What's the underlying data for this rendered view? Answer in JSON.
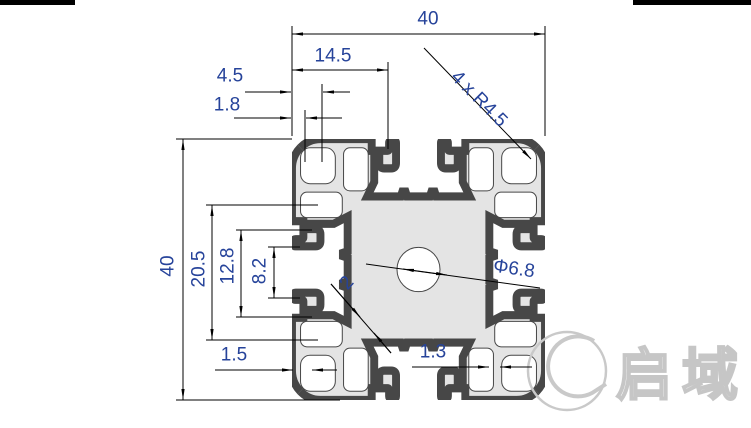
{
  "dimensions": {
    "width_total": "40",
    "height_total": "40",
    "slot_offset": "14.5",
    "corner_radius": "4 x R4.5",
    "lip_depth": "4.5",
    "lip_wall": "1.8",
    "groove_span": "20.5",
    "groove_width": "12.8",
    "slot_opening": "8.2",
    "bottom_wall": "1.5",
    "inner_wall": "1.3",
    "rib_thickness": "2",
    "center_hole_dia": "Φ6.8"
  },
  "watermark": {
    "text": "启域"
  },
  "colors": {
    "dimension_text": "#26439a",
    "dimension_line": "#000000",
    "profile_fill": "#e4e4e4",
    "profile_outline": "#474747",
    "watermark": "#c6c6c6"
  }
}
